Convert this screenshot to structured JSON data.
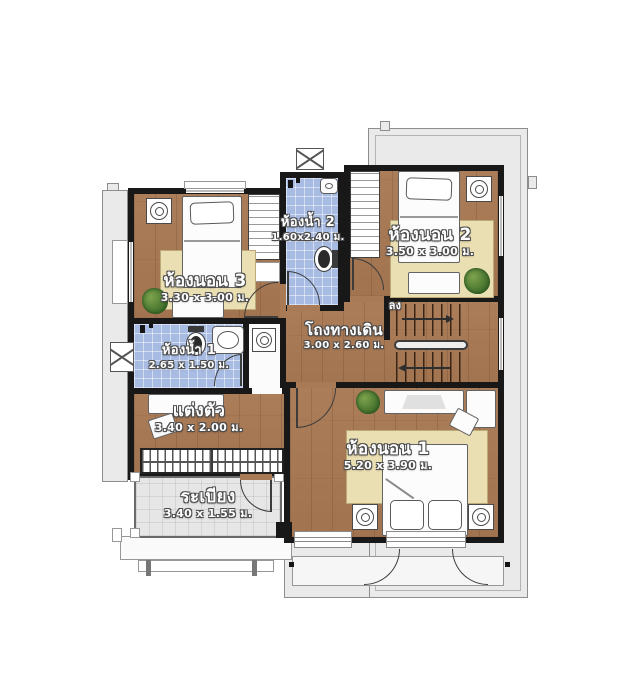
{
  "rooms": {
    "bedroom3": {
      "name": "ห้องนอน 3",
      "size": "3.30 x 3.00 ม."
    },
    "bathroom2": {
      "name": "ห้องน้ำ 2",
      "size": "1.60x2.40 ม."
    },
    "bedroom2": {
      "name": "ห้องนอน 2",
      "size": "3.50 x 3.00 ม."
    },
    "hallway": {
      "name": "โถงทางเดิน",
      "size": "3.00 x 2.60 ม."
    },
    "bathroom1": {
      "name": "ห้องน้ำ 1",
      "size": "2.65 x 1.50 ม."
    },
    "dressing": {
      "name": "แต่งตัว",
      "size": "3.40 x 2.00 ม."
    },
    "bedroom1": {
      "name": "ห้องนอน 1",
      "size": "5.20 x 3.90 ม."
    },
    "balcony": {
      "name": "ระเบียง",
      "size": "3.40 x 1.55 ม."
    }
  },
  "stairs": {
    "down_label": "ลง"
  },
  "colors": {
    "wall": "#181818",
    "wood_floor": "#a87a55",
    "bathroom_tile": "#a7bbe3",
    "balcony_tile": "#e6e6e6",
    "rug": "#eadfb2",
    "roof_overhang": "#eaeaea"
  }
}
